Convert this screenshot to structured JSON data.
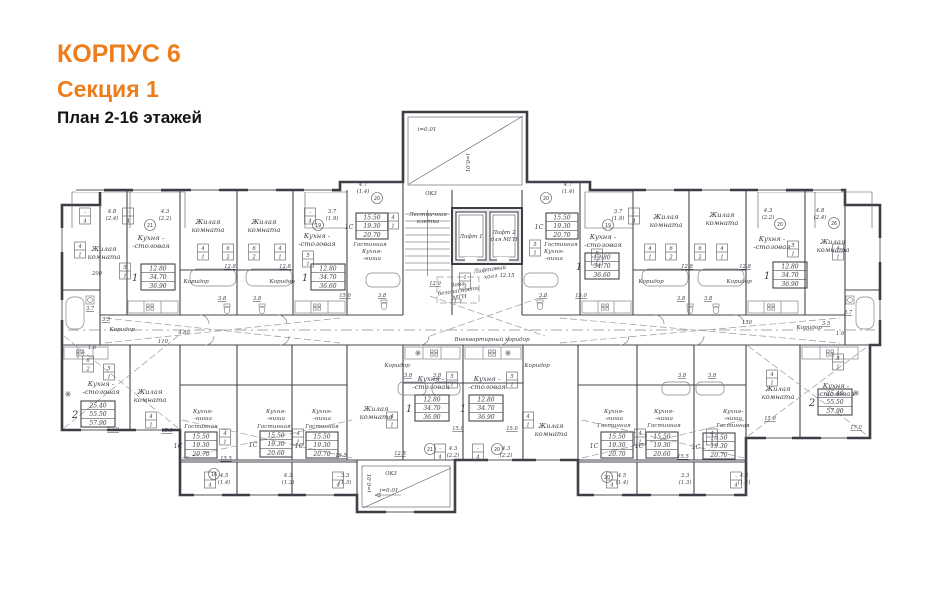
{
  "title": {
    "building": "КОРПУС 6",
    "section": "Секция 1",
    "plan": "План 2-16 этажей"
  },
  "colors": {
    "accent": "#ee7d1b",
    "ink": "#3c3c44"
  },
  "labels": {
    "living": [
      "Жилая",
      "комната"
    ],
    "kitchen": [
      "Кухня -",
      "-столовая"
    ],
    "kitchenette": [
      "Кухня-",
      "-ниша"
    ],
    "lounge": "Гостинная",
    "corridor": "Коридор",
    "main_corridor": "Внеквартирный коридор",
    "stair": [
      "Лестничная",
      "клетка"
    ],
    "lift1": "Лифт 1",
    "lift2": [
      "Лифт 2",
      "для МГН"
    ],
    "lift_hall": [
      "Лифтовый",
      "холл"
    ],
    "safety": [
      "Зона",
      "безопасности",
      "МГН"
    ],
    "slope": "i=0.01",
    "ok3": "ОК3"
  },
  "tables": {
    "one_3690": {
      "type": "1",
      "rows": [
        "12.80",
        "34.70",
        "36.90"
      ]
    },
    "one_3660": {
      "type": "1",
      "rows": [
        "12.80",
        "34.70",
        "36.60"
      ]
    },
    "two_5790": {
      "type": "2",
      "rows": [
        "25.40",
        "55.50",
        "57.90"
      ]
    },
    "st_2070": {
      "type": "1С",
      "rows": [
        "15.50",
        "19.30",
        "20.70"
      ]
    },
    "st_2060": {
      "type": "1С",
      "rows": [
        "15.50",
        "19.30",
        "20.60"
      ]
    }
  },
  "balconies": {
    "b48": [
      "4.8",
      "(2.4)"
    ],
    "b43a": [
      "4.3",
      "(2.2)"
    ],
    "b37": [
      "3.7",
      "(1.9)"
    ],
    "b47": [
      "4.7",
      "(1.4)"
    ],
    "b45": [
      "4.5",
      "(1.4)"
    ],
    "b33": [
      "3.3",
      "(1.3)"
    ],
    "b43b": [
      "4.3",
      "(1.3)"
    ],
    "b43c": [
      "4.3",
      "(1.4)"
    ]
  },
  "tags": {
    "t41": [
      "4",
      "1"
    ],
    "t51": [
      "5",
      "1"
    ],
    "t62": [
      "6",
      "2"
    ],
    "t13": [
      "1",
      "3"
    ],
    "tb4": [
      "–",
      "4"
    ]
  },
  "dims": {
    "d200": "200",
    "d110": "110",
    "d480": "4.80",
    "d1500": "150",
    "d128": "12.8",
    "d150": "15.0",
    "d155": "15.5",
    "d170": "17.0",
    "d120": "12.0",
    "d113": "11.3",
    "d1215": "12.15",
    "d38": "3.8",
    "d37": "3.7",
    "d35": "3.5",
    "d16": "1.6"
  },
  "axes": {
    "a16": "16",
    "a19": "19",
    "a20": "20",
    "a21": "21",
    "a26": "26"
  }
}
